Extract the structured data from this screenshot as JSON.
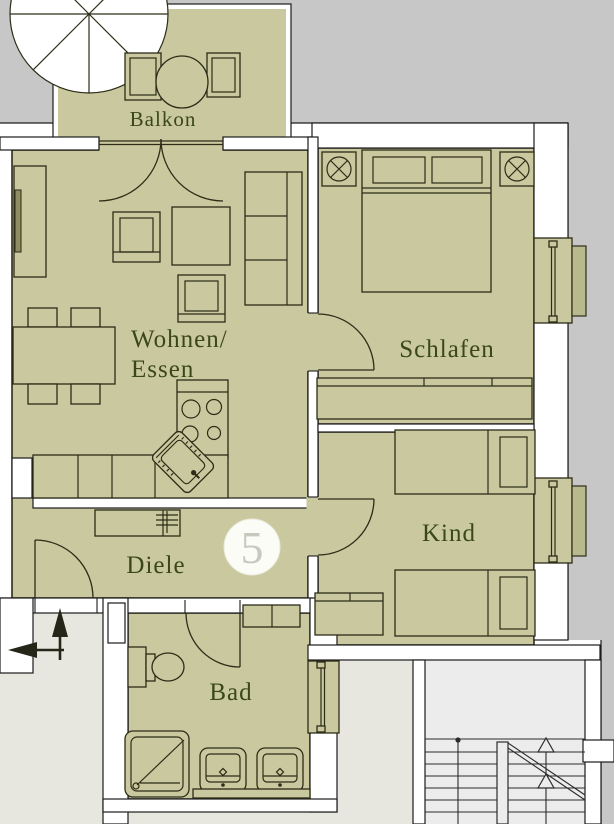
{
  "unit": {
    "number": "5"
  },
  "rooms": {
    "balkon": {
      "label": "Balkon"
    },
    "wohnen_essen": {
      "label_line1": "Wohnen/",
      "label_line2": "Essen"
    },
    "schlafen": {
      "label": "Schlafen"
    },
    "kind": {
      "label": "Kind"
    },
    "diele": {
      "label": "Diele"
    },
    "bad": {
      "label": "Bad"
    }
  },
  "icons": {
    "parasol": "circle-with-8-spokes",
    "ceiling_lamp": "circled-x",
    "entry_direction": "crossed-arrows",
    "stair_direction": "up-triangles",
    "coat_rack": "trident-lines"
  },
  "colors": {
    "floor": "#c9c89e",
    "outside": "#c7c7c7",
    "hallway_floor": "#e7e7e0",
    "stairwell_floor": "#ececec",
    "wall_line": "#1c1c1c",
    "label_text": "#3a471a",
    "unit_number": "#c8c8bf",
    "badge_fill": "#fcfcf7"
  }
}
